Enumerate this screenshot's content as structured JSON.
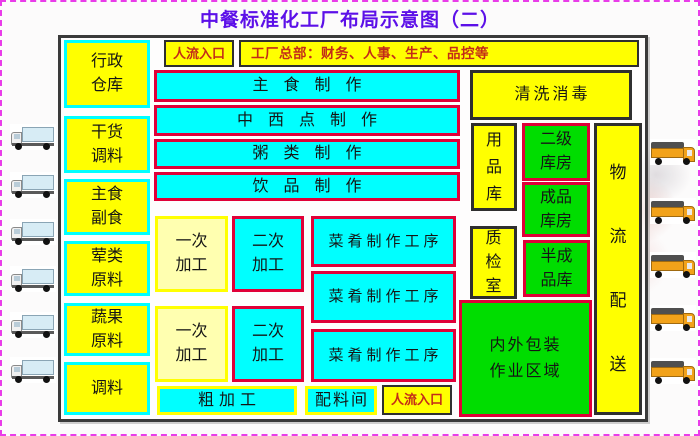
{
  "title": "中餐标准化工厂布局示意图（二）",
  "top": {
    "entrance_label": "人流入口",
    "headquarters_label": "工厂总部：财务、人事、生产、品控等"
  },
  "left_column": [
    "行政\n仓库",
    "干货\n调料",
    "主食\n副食",
    "荤类\n原料",
    "蔬果\n原料",
    "调料"
  ],
  "production_rows": [
    "主食制作",
    "中西点制作",
    "粥类制作",
    "饮品制作"
  ],
  "process_area": {
    "primary_label": "一次\n加工",
    "secondary_label": "二次\n加工",
    "dish_line_label": "菜肴制作工序"
  },
  "bottom_row": {
    "rough_label": "粗加工",
    "ingredient_label": "配料间",
    "entrance_label": "人流入口"
  },
  "right_column": {
    "cleaning_label": "清洗消毒",
    "supplies_label": "用\n品\n库",
    "secondary_storage_label": "二级\n库房",
    "finished_storage_label": "成品\n库房",
    "qc_label": "质\n检\n室",
    "semi_finished_label": "半成\n品库",
    "packaging_label": "内外包装\n作业区域",
    "logistics_label": "物\n流\n配\n送"
  },
  "icons": {
    "left_truck": "delivery-truck-left-icon",
    "right_truck": "delivery-truck-right-icon",
    "left_truck_count": 6,
    "right_truck_count": 5
  },
  "colors": {
    "title_text": "#5c10e8",
    "yellow": "#ffff00",
    "cyan": "#00ffff",
    "green": "#00dd00",
    "pale_yellow": "#ffffb0",
    "red_border": "#e00038",
    "dark_border": "#2f2f2f",
    "red_text": "#c32b18",
    "page_border": "#e93ce9"
  }
}
